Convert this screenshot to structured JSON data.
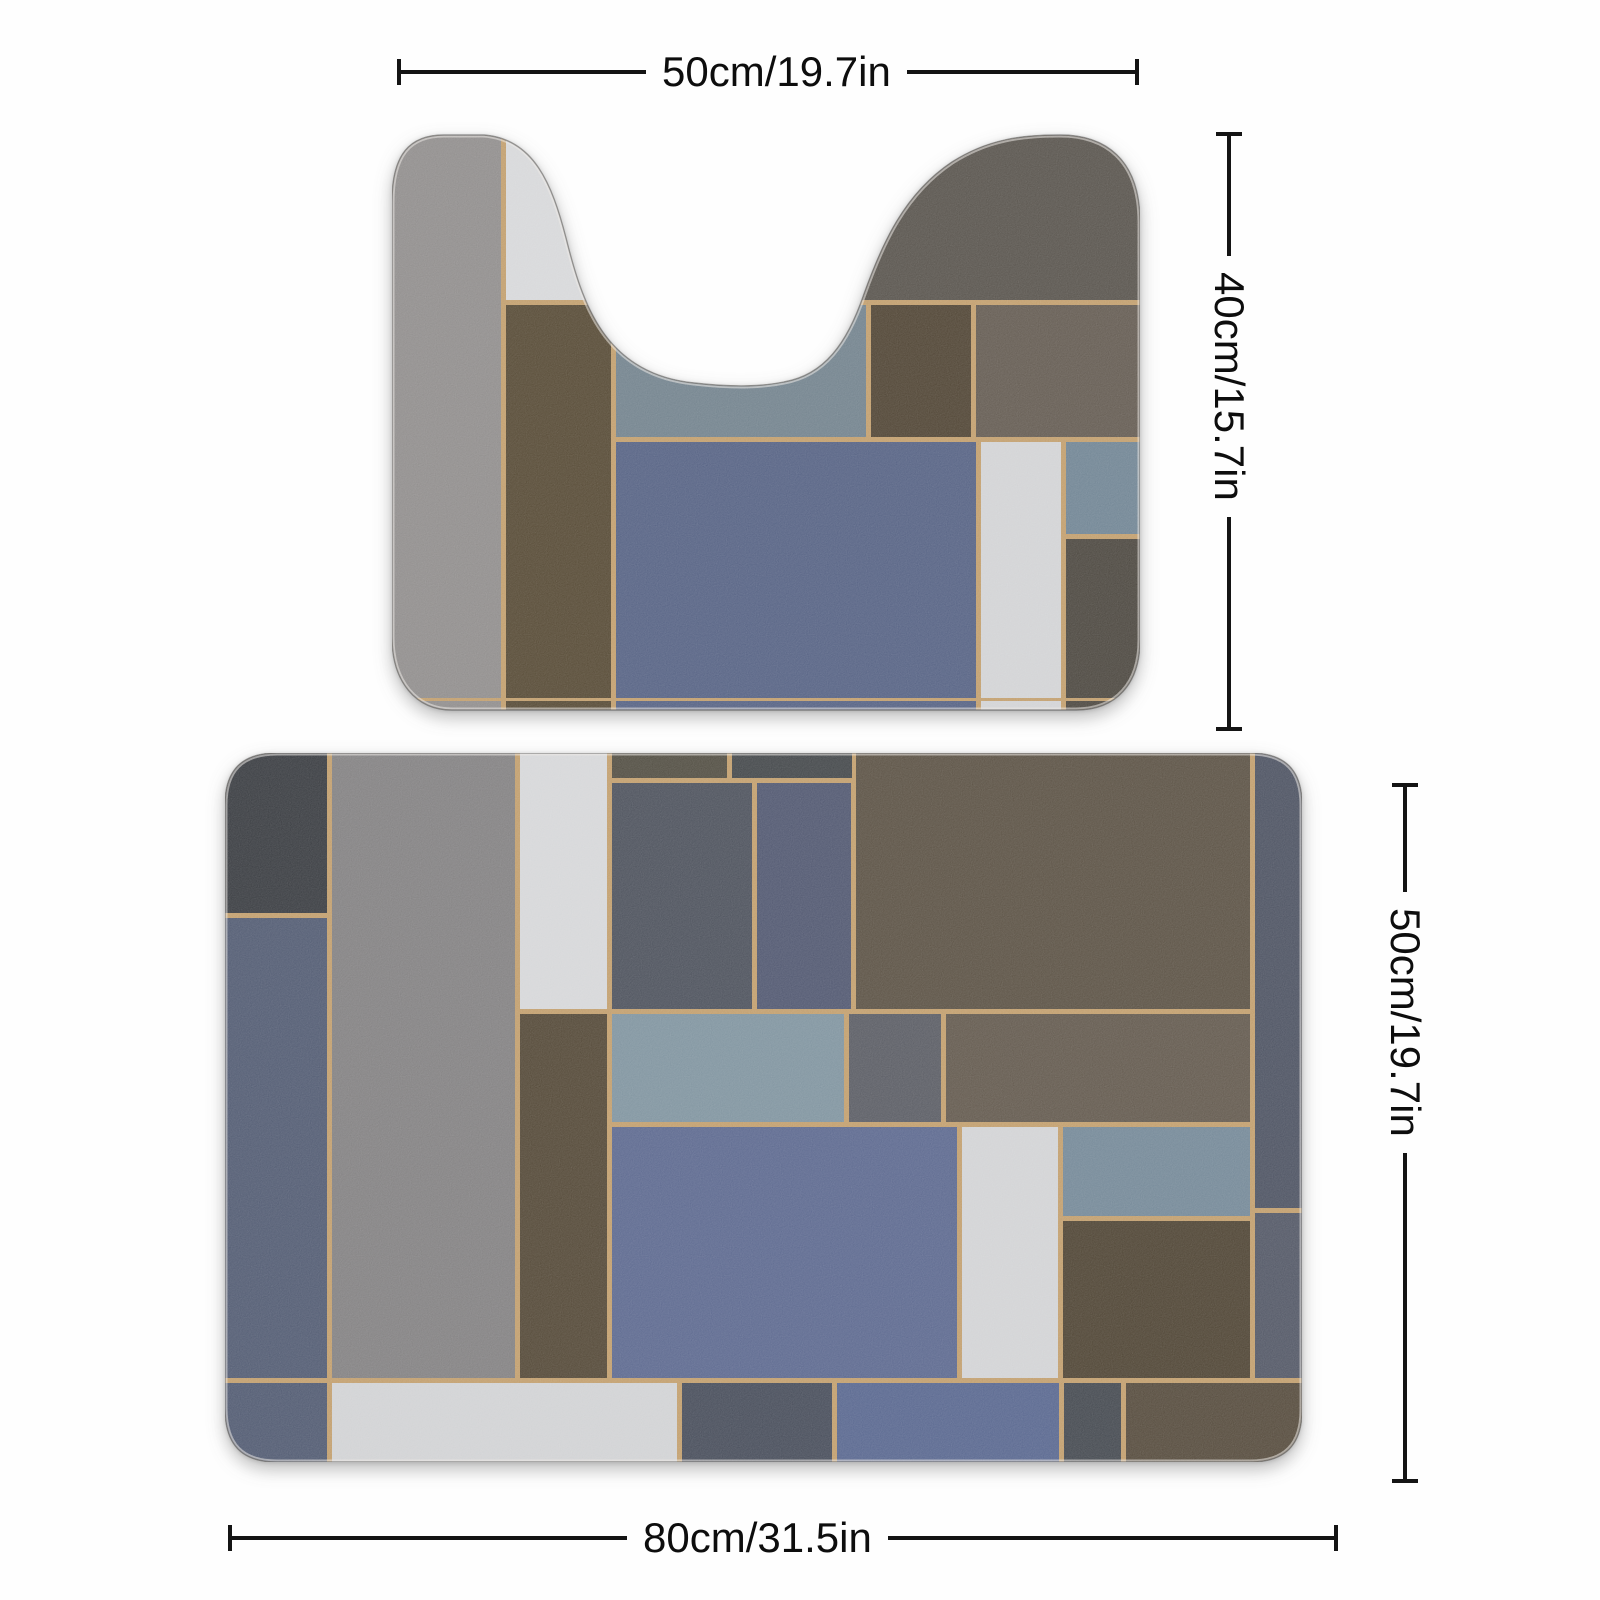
{
  "background": "#fefefe",
  "dims": {
    "top_width": {
      "label": "50cm/19.7in"
    },
    "contour_height": {
      "label": "40cm/15.7in"
    },
    "mat_height": {
      "label": "50cm/19.7in"
    },
    "bottom_width": {
      "label": "80cm/31.5in"
    }
  },
  "palette": {
    "grout_gold": "#bf9a66",
    "line_ink": "#141414",
    "edge_rim": "#eceae6"
  },
  "mats": {
    "contour_mat": {
      "kind": "u-shaped-contour-mat",
      "viewBox": "0 0 748 580",
      "base_color": "#bf9a66",
      "outline": "M 0,505 L 0,70 C 0,22 18,3 52,3 L 92,3 C 142,7 160,52 174,106 C 190,170 212,242 302,251 C 346,256 372,254 392,250 C 432,243 455,212 472,162 C 490,112 512,62 560,30 C 596,7 630,3 668,3 C 712,3 748,26 748,90 L 748,508 C 748,552 724,578 684,578 L 60,578 C 24,578 0,550 0,505 Z",
      "patches": [
        {
          "x": 0,
          "y": 0,
          "w": 109,
          "h": 580,
          "color": "#8b8887"
        },
        {
          "x": 114,
          "y": 0,
          "w": 105,
          "h": 168,
          "color": "#d5d6d8"
        },
        {
          "x": 114,
          "y": 173,
          "w": 105,
          "h": 407,
          "color": "#4f422c"
        },
        {
          "x": 224,
          "y": 173,
          "w": 250,
          "h": 132,
          "color": "#6c7d88"
        },
        {
          "x": 224,
          "y": 310,
          "w": 360,
          "h": 270,
          "color": "#4e5b7e"
        },
        {
          "x": 380,
          "y": 0,
          "w": 368,
          "h": 168,
          "color": "#514c45"
        },
        {
          "x": 479,
          "y": 173,
          "w": 100,
          "h": 132,
          "color": "#483c2b"
        },
        {
          "x": 584,
          "y": 173,
          "w": 164,
          "h": 132,
          "color": "#5d544a"
        },
        {
          "x": 589,
          "y": 310,
          "w": 80,
          "h": 270,
          "color": "#d0d1d3"
        },
        {
          "x": 674,
          "y": 310,
          "w": 74,
          "h": 92,
          "color": "#6a7f8f"
        },
        {
          "x": 674,
          "y": 407,
          "w": 74,
          "h": 173,
          "color": "#443f37"
        }
      ],
      "overlay_lines": [
        {
          "x": 0,
          "y": 566,
          "w": 748,
          "h": 3
        }
      ]
    },
    "rect_mat": {
      "kind": "rectangular-bath-mat",
      "viewBox": "0 0 1077 709",
      "base_color": "#bf9a66",
      "outline": "M 0,655 L 0,52 C 0,17 17,0 52,0 L 1025,0 C 1060,0 1077,17 1077,52 L 1077,657 C 1077,692 1060,709 1025,709 L 52,709 C 17,709 0,692 0,655 Z",
      "patches": [
        {
          "x": 0,
          "y": 0,
          "w": 102,
          "h": 160,
          "color": "#303338"
        },
        {
          "x": 0,
          "y": 165,
          "w": 102,
          "h": 460,
          "color": "#4a546c"
        },
        {
          "x": 0,
          "y": 630,
          "w": 102,
          "h": 79,
          "color": "#49536b"
        },
        {
          "x": 107,
          "y": 0,
          "w": 183,
          "h": 625,
          "color": "#7d7b7c"
        },
        {
          "x": 295,
          "y": 0,
          "w": 87,
          "h": 256,
          "color": "#d4d5d7"
        },
        {
          "x": 295,
          "y": 261,
          "w": 87,
          "h": 364,
          "color": "#4c402e"
        },
        {
          "x": 387,
          "y": 0,
          "w": 115,
          "h": 25,
          "color": "#4a463a"
        },
        {
          "x": 507,
          "y": 0,
          "w": 120,
          "h": 25,
          "color": "#3b3f42"
        },
        {
          "x": 387,
          "y": 30,
          "w": 140,
          "h": 226,
          "color": "#454a55"
        },
        {
          "x": 532,
          "y": 30,
          "w": 94,
          "h": 226,
          "color": "#49506a"
        },
        {
          "x": 631,
          "y": 0,
          "w": 394,
          "h": 256,
          "color": "#544a3c"
        },
        {
          "x": 1030,
          "y": 0,
          "w": 47,
          "h": 455,
          "color": "#454b5b"
        },
        {
          "x": 1030,
          "y": 460,
          "w": 47,
          "h": 165,
          "color": "#4b505f"
        },
        {
          "x": 387,
          "y": 261,
          "w": 232,
          "h": 108,
          "color": "#7a8f9b"
        },
        {
          "x": 624,
          "y": 261,
          "w": 92,
          "h": 108,
          "color": "#53555d"
        },
        {
          "x": 721,
          "y": 261,
          "w": 304,
          "h": 108,
          "color": "#5c5246"
        },
        {
          "x": 387,
          "y": 374,
          "w": 345,
          "h": 251,
          "color": "#55628a"
        },
        {
          "x": 737,
          "y": 374,
          "w": 96,
          "h": 251,
          "color": "#d0d1d3"
        },
        {
          "x": 838,
          "y": 374,
          "w": 187,
          "h": 89,
          "color": "#6e8393"
        },
        {
          "x": 838,
          "y": 468,
          "w": 187,
          "h": 157,
          "color": "#473c2b"
        },
        {
          "x": 107,
          "y": 630,
          "w": 345,
          "h": 79,
          "color": "#cfd0d2"
        },
        {
          "x": 457,
          "y": 630,
          "w": 150,
          "h": 79,
          "color": "#3f4553"
        },
        {
          "x": 612,
          "y": 630,
          "w": 222,
          "h": 79,
          "color": "#51608a"
        },
        {
          "x": 839,
          "y": 630,
          "w": 57,
          "h": 79,
          "color": "#3c4148"
        },
        {
          "x": 901,
          "y": 630,
          "w": 176,
          "h": 79,
          "color": "#4e4334"
        }
      ],
      "overlay_lines": []
    }
  }
}
